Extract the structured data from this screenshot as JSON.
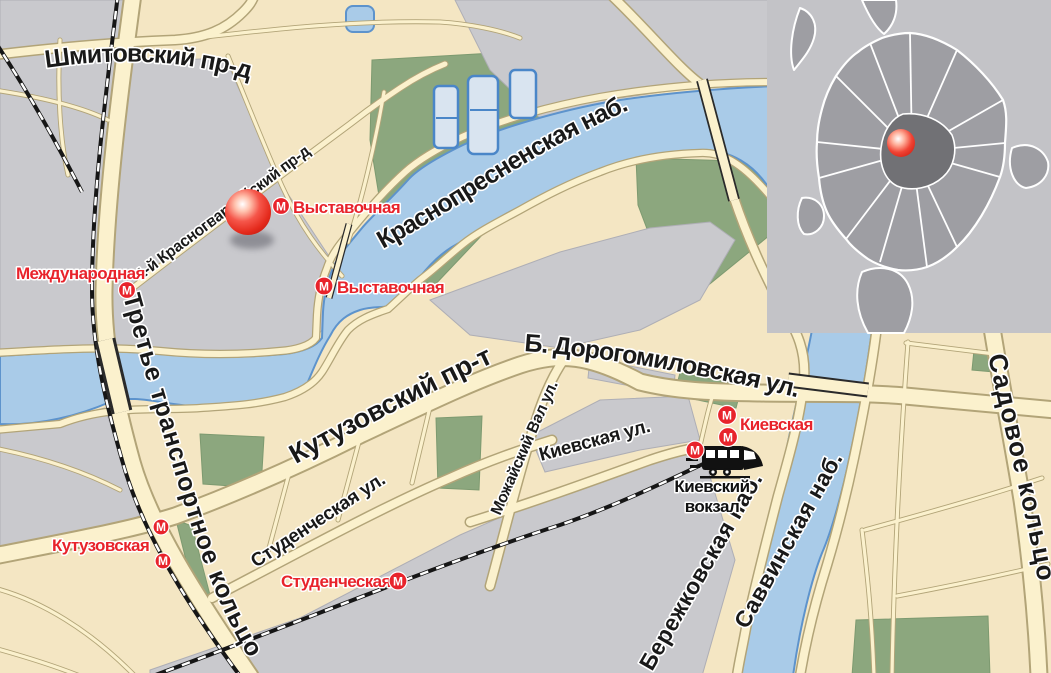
{
  "streets": [
    {
      "id": "shmitovsky",
      "name": "Шмитовский пр-д"
    },
    {
      "id": "krasnogvardeysky",
      "name": "1-й Красногвардейский пр-д"
    },
    {
      "id": "krasnopresnenskaya",
      "name": "Краснопресненская наб."
    },
    {
      "id": "kutuzovsky",
      "name": "Кутузовский пр-т"
    },
    {
      "id": "dorogomilovskaya",
      "name": "Б. Дорогомиловская ул."
    },
    {
      "id": "studencheskaya-ul",
      "name": "Студенческая ул."
    },
    {
      "id": "mozhaisky-val",
      "name": "Можайский Вал ул."
    },
    {
      "id": "kievskaya-ul",
      "name": "Киевская ул."
    },
    {
      "id": "tretye-koltso",
      "name": "Третье транспортное кольцо"
    },
    {
      "id": "berezhkovskaya",
      "name": "Бережковская наб."
    },
    {
      "id": "savvinskaya",
      "name": "Саввинская наб."
    },
    {
      "id": "sadovoe",
      "name": "Садовое кольцо"
    }
  ],
  "metro": {
    "icon_letter": "М",
    "stations": [
      {
        "id": "vystavochnaya-1",
        "name": "Выставочная"
      },
      {
        "id": "vystavochnaya-2",
        "name": "Выставочная"
      },
      {
        "id": "mezhdunarodnaya",
        "name": "Международная"
      },
      {
        "id": "kutuzovskaya",
        "name": "Кутузовская"
      },
      {
        "id": "studencheskaya",
        "name": "Студенческая"
      },
      {
        "id": "kievskaya",
        "name": "Киевская"
      }
    ]
  },
  "railway_station": {
    "name_line1": "Киевский",
    "name_line2": "вокзал"
  },
  "marker": {
    "type": "location-highlight-ball"
  },
  "inset": {
    "type": "moscow-city-overview",
    "marker": "red-dot"
  },
  "colors": {
    "land_beige": "#f4e6c3",
    "block_gray": "#c9c9cd",
    "water_blue": "#a9cbe8",
    "water_outline": "#5d93cc",
    "road_fill": "#fbf1cd",
    "road_casing": "#b2a478",
    "park_green": "#8ca77e",
    "metro_red": "#e8232b",
    "label_black": "#191919",
    "inset_bg": "#c3c3c7",
    "inset_city": "#9e9ea3",
    "inset_center": "#717175"
  }
}
